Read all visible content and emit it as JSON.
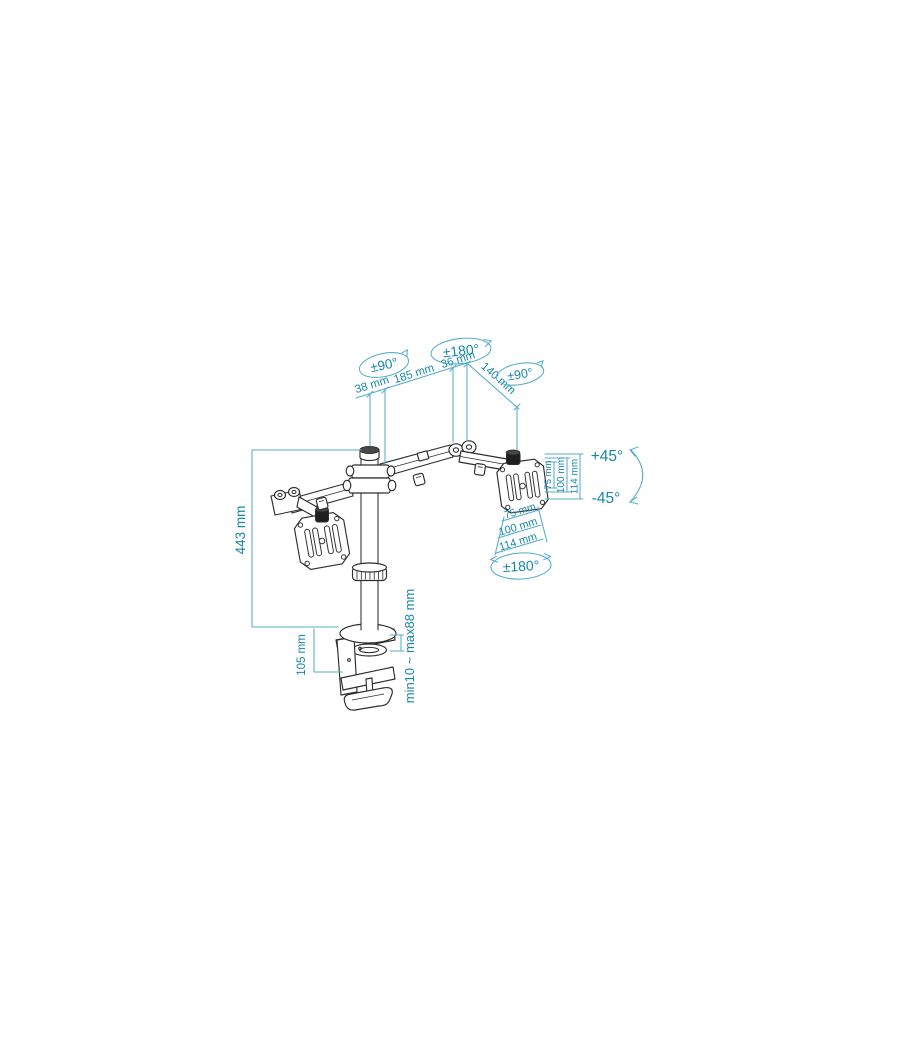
{
  "page": {
    "width": 900,
    "height": 1050,
    "background": "#ffffff"
  },
  "colors": {
    "ink": "#2d2d2d",
    "dim_line": "#54adca",
    "dim_text": "#1787a7"
  },
  "drawing": {
    "subject": "Dual-arm desk monitor mount, dimensioned technical illustration",
    "angles": {
      "left_arm_swivel": "±90°",
      "elbow_swivel": "±180°",
      "head_swivel": "±90°",
      "tilt_up": "+45°",
      "tilt_down": "-45°",
      "vesa_rotation": "±180°"
    },
    "lengths": {
      "seg_a": "38 mm",
      "seg_b": "185 mm",
      "seg_c": "36 mm",
      "forearm": "140 mm",
      "pole_height": "443 mm",
      "clamp_height": "105 mm",
      "desk_thickness": "min10 ~ max88 mm"
    },
    "vesa_side": {
      "a": "75 mm",
      "b": "100 mm",
      "c": "114 mm"
    },
    "vesa_under": {
      "a": "75 mm",
      "b": "100 mm",
      "c": "114 mm"
    }
  }
}
